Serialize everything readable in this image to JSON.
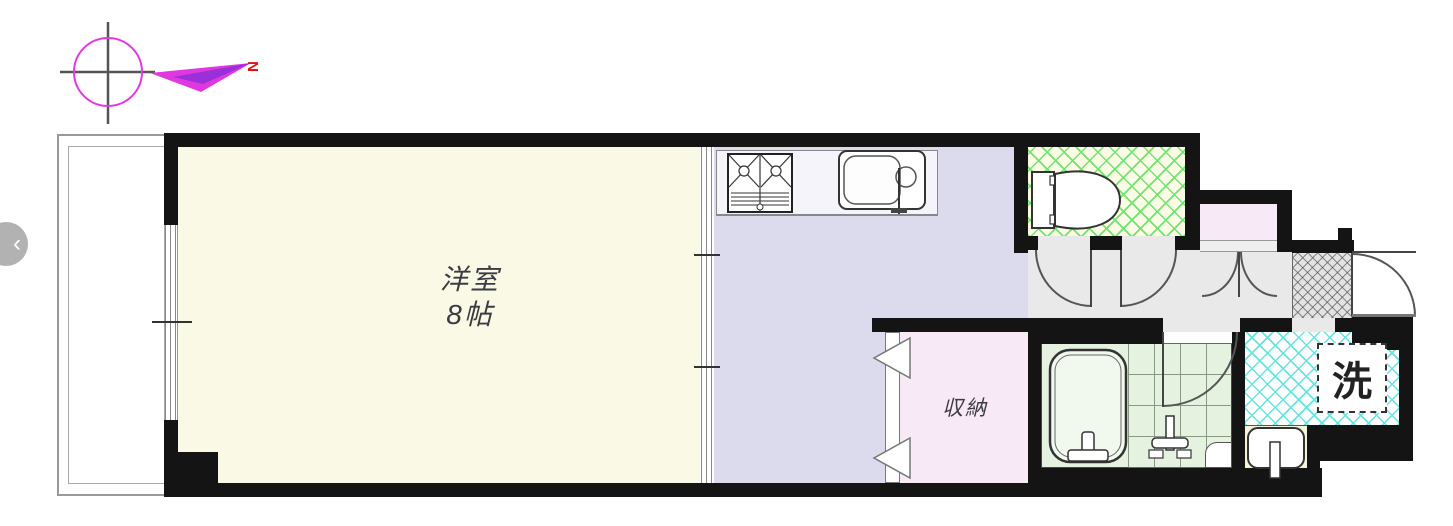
{
  "viewer": {
    "prev_button": "‹"
  },
  "compass": {
    "north_label": "N"
  },
  "floorplan": {
    "western_room": {
      "name": "洋室",
      "size": "8帖"
    },
    "closet": {
      "name": "収納"
    },
    "laundry": {
      "name": "洗"
    }
  },
  "colors": {
    "wall": "#141414",
    "cream": "#faf9e6",
    "lav": "#dcdbee",
    "pink": "#f8e9f6",
    "hall": "#e9e9e9",
    "toiletbg": "#fcfce6",
    "hatchgreen": "#6fe46f",
    "hatchcyan": "#66e4e0",
    "bathgreen": "#e4f2df",
    "counter": "#f4f4fa",
    "nook": "#f6f3d8",
    "magenta": "#e23ae2",
    "northred": "#e11414",
    "btngray": "#b2b2b2"
  }
}
